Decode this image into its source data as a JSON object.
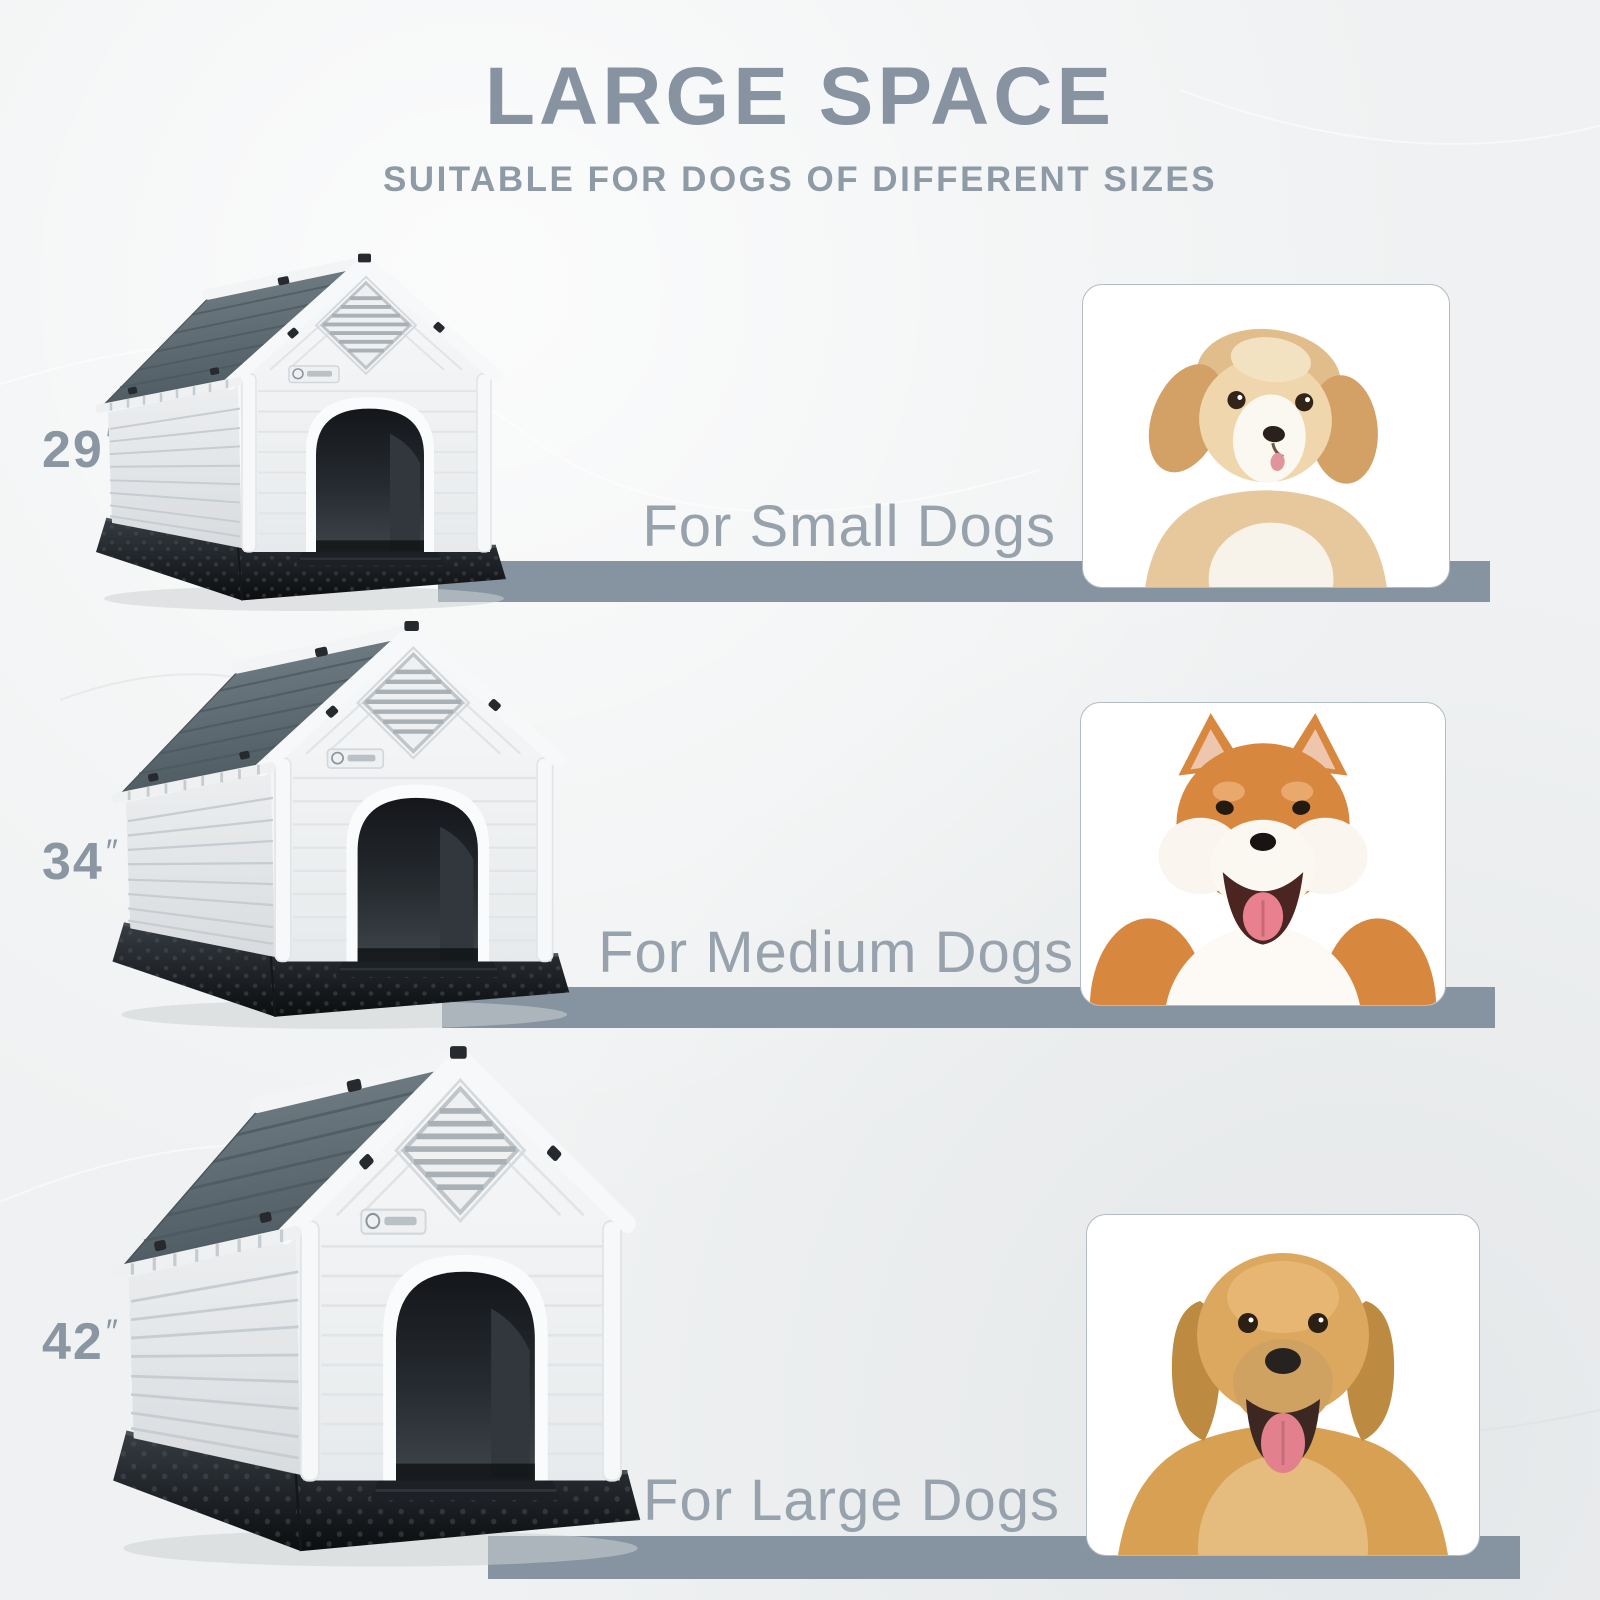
{
  "header": {
    "title": "LARGE SPACE",
    "subtitle": "SUITABLE FOR DOGS OF DIFFERENT SIZES"
  },
  "rows": [
    {
      "size_value": "29",
      "size_unit": "″",
      "label": "For Small Dogs",
      "photo": "Fluffy tan and white small puppy"
    },
    {
      "size_value": "34",
      "size_unit": "″",
      "label": "For Medium Dogs",
      "photo": "Smiling Shiba Inu"
    },
    {
      "size_value": "42",
      "size_unit": "″",
      "label": "For Large Dogs",
      "photo": "Golden Retriever"
    }
  ],
  "colors": {
    "heading_gray": "#8793A0",
    "label_gray": "#97A2AC",
    "size_gray": "#8A96A2",
    "bar_slate": "#8693A1",
    "background": "#EFF1F2",
    "card_border": "#B3BCC4",
    "house_roof": "#5E6C73",
    "house_wall": "#F2F4F5",
    "house_base": "#1B1F23"
  }
}
